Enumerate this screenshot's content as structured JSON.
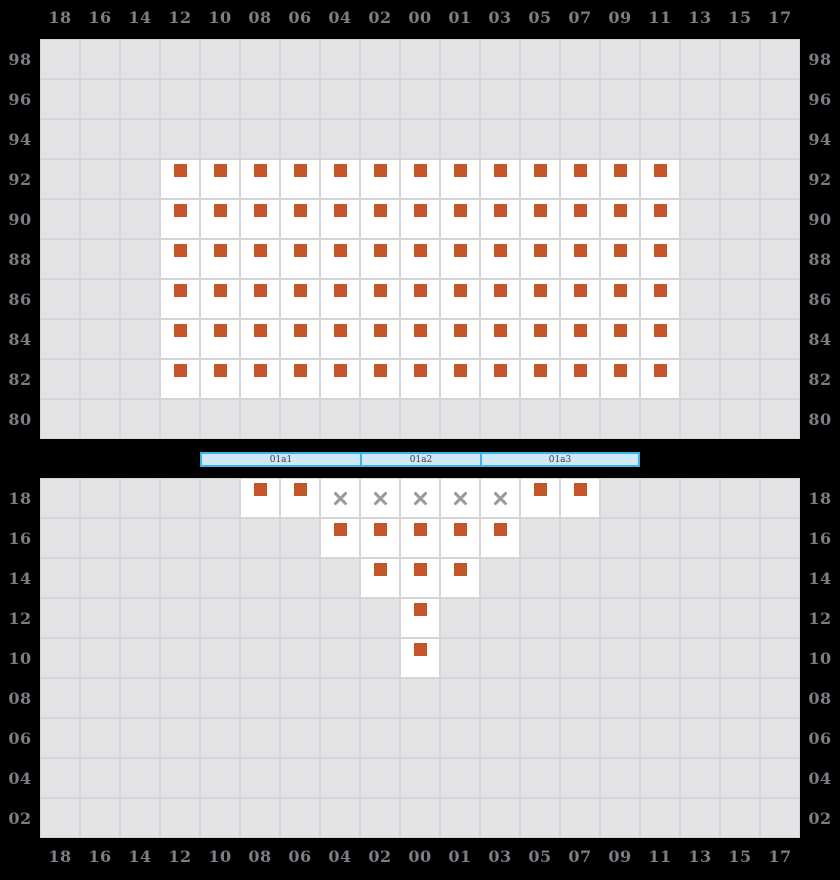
{
  "colors": {
    "background": "#000000",
    "cell_empty_bg": "#e3e3e6",
    "cell_line": "#d6d6da",
    "cell_seat_bg": "#ffffff",
    "seat_marker": "#c7552b",
    "x_mark": "#9a9aa1",
    "axis_label": "#7d7d86",
    "stage_fill": "#cfe8f7",
    "stage_border": "#3eb3ea",
    "stage_label": "#3a3a42"
  },
  "cell_states": {
    "0": "empty",
    "1": "occupied-seat-marker",
    "2": "unavailable-x"
  },
  "axis": {
    "columns": [
      "18",
      "16",
      "14",
      "12",
      "10",
      "08",
      "06",
      "04",
      "02",
      "00",
      "01",
      "03",
      "05",
      "07",
      "09",
      "11",
      "13",
      "15",
      "17"
    ]
  },
  "top_section": {
    "row_labels": [
      "98",
      "96",
      "94",
      "92",
      "90",
      "88",
      "86",
      "84",
      "82",
      "80"
    ],
    "cells": [
      [
        0,
        0,
        0,
        0,
        0,
        0,
        0,
        0,
        0,
        0,
        0,
        0,
        0,
        0,
        0,
        0,
        0,
        0,
        0
      ],
      [
        0,
        0,
        0,
        0,
        0,
        0,
        0,
        0,
        0,
        0,
        0,
        0,
        0,
        0,
        0,
        0,
        0,
        0,
        0
      ],
      [
        0,
        0,
        0,
        0,
        0,
        0,
        0,
        0,
        0,
        0,
        0,
        0,
        0,
        0,
        0,
        0,
        0,
        0,
        0
      ],
      [
        0,
        0,
        0,
        1,
        1,
        1,
        1,
        1,
        1,
        1,
        1,
        1,
        1,
        1,
        1,
        1,
        0,
        0,
        0
      ],
      [
        0,
        0,
        0,
        1,
        1,
        1,
        1,
        1,
        1,
        1,
        1,
        1,
        1,
        1,
        1,
        1,
        0,
        0,
        0
      ],
      [
        0,
        0,
        0,
        1,
        1,
        1,
        1,
        1,
        1,
        1,
        1,
        1,
        1,
        1,
        1,
        1,
        0,
        0,
        0
      ],
      [
        0,
        0,
        0,
        1,
        1,
        1,
        1,
        1,
        1,
        1,
        1,
        1,
        1,
        1,
        1,
        1,
        0,
        0,
        0
      ],
      [
        0,
        0,
        0,
        1,
        1,
        1,
        1,
        1,
        1,
        1,
        1,
        1,
        1,
        1,
        1,
        1,
        0,
        0,
        0
      ],
      [
        0,
        0,
        0,
        1,
        1,
        1,
        1,
        1,
        1,
        1,
        1,
        1,
        1,
        1,
        1,
        1,
        0,
        0,
        0
      ],
      [
        0,
        0,
        0,
        0,
        0,
        0,
        0,
        0,
        0,
        0,
        0,
        0,
        0,
        0,
        0,
        0,
        0,
        0,
        0
      ]
    ]
  },
  "stage": {
    "segments": [
      {
        "label": "01a1"
      },
      {
        "label": "01a2"
      },
      {
        "label": "01a3"
      }
    ]
  },
  "bottom_section": {
    "row_labels": [
      "18",
      "16",
      "14",
      "12",
      "10",
      "08",
      "06",
      "04",
      "02"
    ],
    "cells": [
      [
        0,
        0,
        0,
        0,
        0,
        1,
        1,
        2,
        2,
        2,
        2,
        2,
        1,
        1,
        0,
        0,
        0,
        0,
        0
      ],
      [
        0,
        0,
        0,
        0,
        0,
        0,
        0,
        1,
        1,
        1,
        1,
        1,
        0,
        0,
        0,
        0,
        0,
        0,
        0
      ],
      [
        0,
        0,
        0,
        0,
        0,
        0,
        0,
        0,
        1,
        1,
        1,
        0,
        0,
        0,
        0,
        0,
        0,
        0,
        0
      ],
      [
        0,
        0,
        0,
        0,
        0,
        0,
        0,
        0,
        0,
        1,
        0,
        0,
        0,
        0,
        0,
        0,
        0,
        0,
        0
      ],
      [
        0,
        0,
        0,
        0,
        0,
        0,
        0,
        0,
        0,
        1,
        0,
        0,
        0,
        0,
        0,
        0,
        0,
        0,
        0
      ],
      [
        0,
        0,
        0,
        0,
        0,
        0,
        0,
        0,
        0,
        0,
        0,
        0,
        0,
        0,
        0,
        0,
        0,
        0,
        0
      ],
      [
        0,
        0,
        0,
        0,
        0,
        0,
        0,
        0,
        0,
        0,
        0,
        0,
        0,
        0,
        0,
        0,
        0,
        0,
        0
      ],
      [
        0,
        0,
        0,
        0,
        0,
        0,
        0,
        0,
        0,
        0,
        0,
        0,
        0,
        0,
        0,
        0,
        0,
        0,
        0
      ],
      [
        0,
        0,
        0,
        0,
        0,
        0,
        0,
        0,
        0,
        0,
        0,
        0,
        0,
        0,
        0,
        0,
        0,
        0,
        0
      ]
    ]
  }
}
